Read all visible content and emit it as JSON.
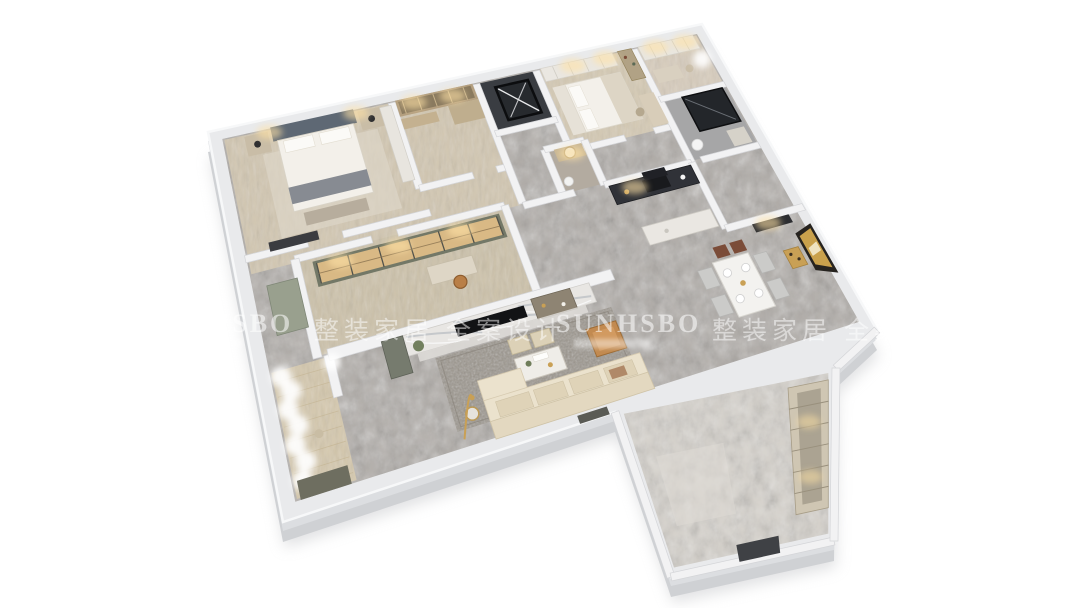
{
  "watermark": {
    "brand": "SUNHSBO",
    "tagline": "整装家居 全案设计"
  },
  "palette": {
    "background": "#ffffff",
    "outer_wall": "#e9eaec",
    "outer_wall_edge": "#c9cbce",
    "slab_side": "#dcdee1",
    "slab_base": "#cfd1d4",
    "inner_wall": "#f2f2f3",
    "inner_wall_edge": "#d4d5d8",
    "marble_floor": "#b3afaa",
    "marble_light": "#d8d4ce",
    "wood_floor": "#d3c8b2",
    "wood_study": "#cec3ab",
    "wood_balcony": "#d6c9ae",
    "bath_gray": "#a6a6a7",
    "bath_warm": "#b3aba0",
    "dark_shaft": "#3a3d42",
    "counter_dark": "#303238",
    "hood_dark": "#202126",
    "tv_black": "#121315",
    "sofa_cream": "#ebe2cd",
    "cushion": "#dfd3b8",
    "armchair_tan": "#c28a50",
    "gold_accent": "#c9a055",
    "headboard_blue": "#5e6874",
    "bed_white": "#f3f0ea",
    "nightstand_wood": "#c9bda7",
    "wardrobe_wood": "#b49f7f",
    "shelf_olive": "#737867",
    "shelf_glow_wood": "#d9b985",
    "cabinet_green": "#99a08e",
    "balcony_cabinet": "#6e6e60",
    "marble_wall": "#e8e6e3",
    "shelf_unit": "#8e8473",
    "chair_brown": "#7b4c38",
    "chair_gray": "#cbcbc9",
    "art_frame": "#26231f",
    "art_gold": "#c9a14c",
    "ext_cabinet": "#cfc6b3",
    "doorway_dark": "#3f4145",
    "glow_warm": "#ffe3a6",
    "curtain_white": "#ffffff"
  }
}
